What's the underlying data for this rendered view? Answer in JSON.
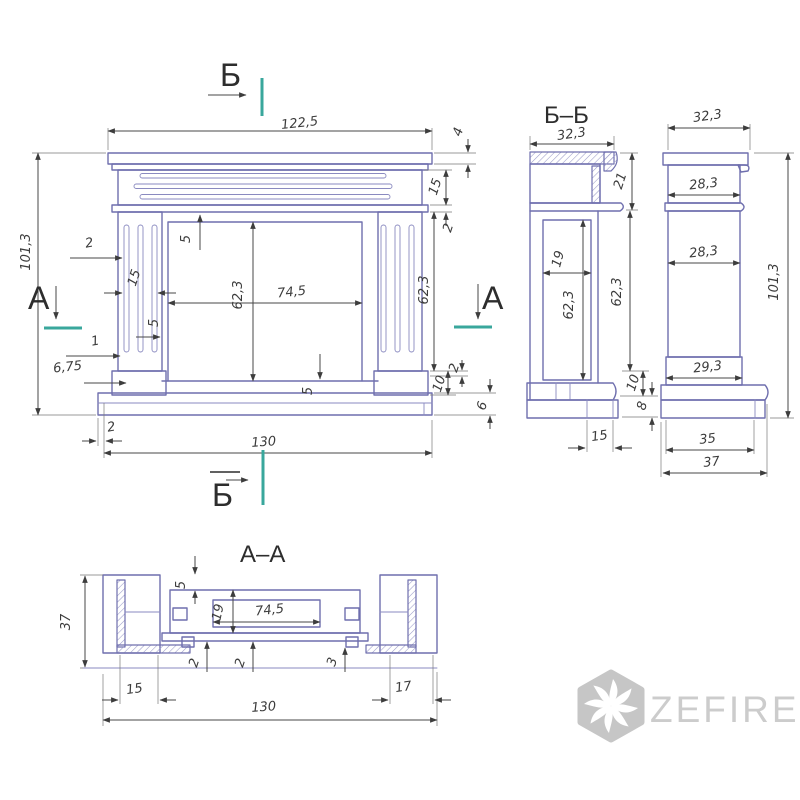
{
  "markers": {
    "a": "А",
    "b": "Б"
  },
  "front": {
    "dims": {
      "width_top": "122,5",
      "shelf_h": "4",
      "frieze_h": "15",
      "band_h": "2",
      "pilaster_h": "62,3",
      "height": "101,3",
      "flute_w": "2",
      "flute_grp": "15",
      "gap_top": "5",
      "gap_side": "5",
      "opening_h": "62,3",
      "opening_w": "74,5",
      "flute_one": "1",
      "flute_off": "6,75",
      "hearth_t": "5",
      "plinth_h": "10",
      "step_h": "2",
      "base_h": "6",
      "base_off": "2",
      "width_total": "130"
    }
  },
  "section_b": {
    "title": "Б–Б",
    "dims": {
      "depth_top": "32,3",
      "top_h": "21",
      "cavity_w": "19",
      "cavity_h": "62,3",
      "body_h": "62,3",
      "plinth_h": "10",
      "base_h": "8",
      "foot_w": "15"
    }
  },
  "side": {
    "dims": {
      "depth_top": "32,3",
      "col_top_w": "28,3",
      "col_w": "28,3",
      "col_bot_w": "29,3",
      "height": "101,3",
      "base_w": "35",
      "base_total_w": "37"
    }
  },
  "section_a": {
    "title": "А–А",
    "dims": {
      "depth": "37",
      "front_gap": "5",
      "panel_d": "19",
      "opening_w": "74,5",
      "wall_left": "2",
      "wall_mid": "2",
      "wall_right": "3",
      "foot_left": "15",
      "foot_right": "17",
      "width_total": "130"
    }
  },
  "watermark": {
    "brand": "ZEFIRE"
  }
}
